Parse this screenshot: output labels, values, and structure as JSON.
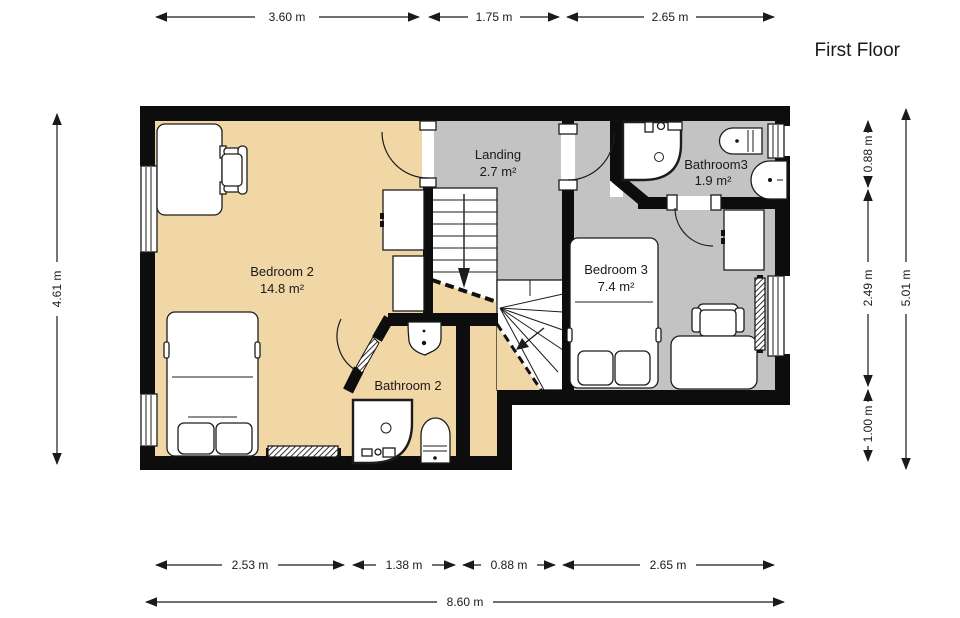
{
  "title": "First Floor",
  "rooms": {
    "bedroom2": {
      "name": "Bedroom 2",
      "area": "14.8 m²"
    },
    "landing": {
      "name": "Landing",
      "area": "2.7 m²"
    },
    "bathroom3": {
      "name": "Bathroom3",
      "area": "1.9 m²"
    },
    "bedroom3": {
      "name": "Bedroom 3",
      "area": "7.4 m²"
    },
    "bathroom2": {
      "name": "Bathroom 2"
    }
  },
  "dimensions": {
    "top": [
      "3.60 m",
      "1.75 m",
      "2.65 m"
    ],
    "bottom": [
      "2.53 m",
      "1.38 m",
      "0.88 m",
      "2.65 m"
    ],
    "bottom_total": "8.60 m",
    "left": "4.61 m",
    "right": [
      "0.88 m",
      "2.49 m",
      "1.00 m"
    ],
    "right_total": "5.01 m"
  },
  "colors": {
    "warm_room": "#f2d7a6",
    "gray_room": "#c3c3c3",
    "wall": "#0d0d0d"
  }
}
